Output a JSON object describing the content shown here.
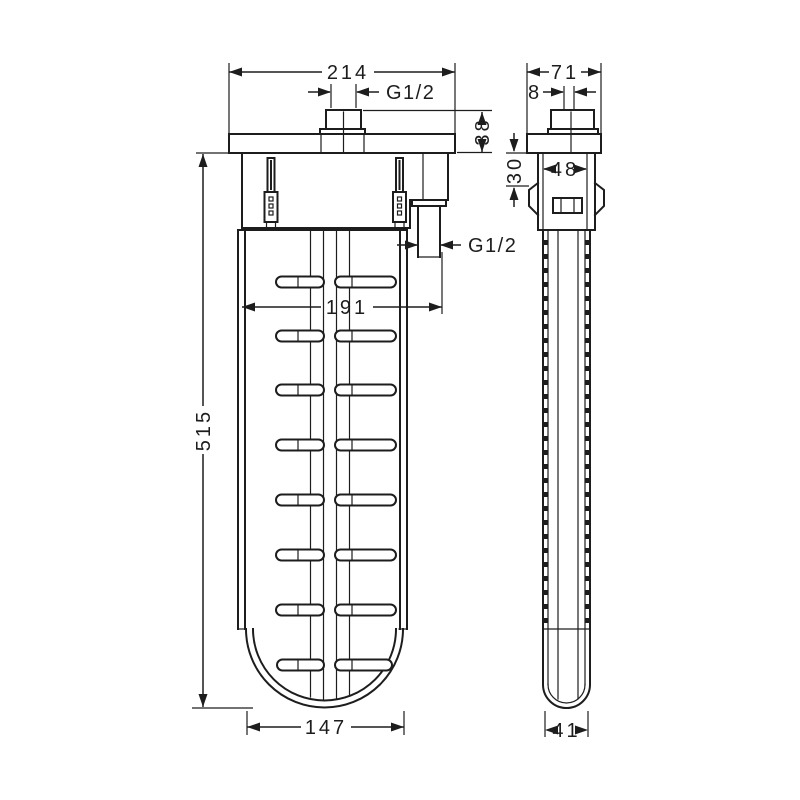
{
  "drawing": {
    "kind": "technical-dimension-drawing",
    "colors": {
      "line": "#1d1d1d",
      "background": "#ffffff"
    },
    "front_view": {
      "dim_plate_width": "214",
      "dim_top_thread": "G1/2",
      "dim_plate_drop": "38",
      "dim_total_height": "515",
      "dim_outlet_offset": "191",
      "dim_side_thread": "G1/2",
      "dim_body_width": "147"
    },
    "side_view": {
      "dim_plate_depth": "71",
      "dim_thread_offset": "8",
      "dim_clip_depth": "30",
      "dim_body_inner_depth": "48",
      "dim_shaft_depth": "41"
    }
  }
}
